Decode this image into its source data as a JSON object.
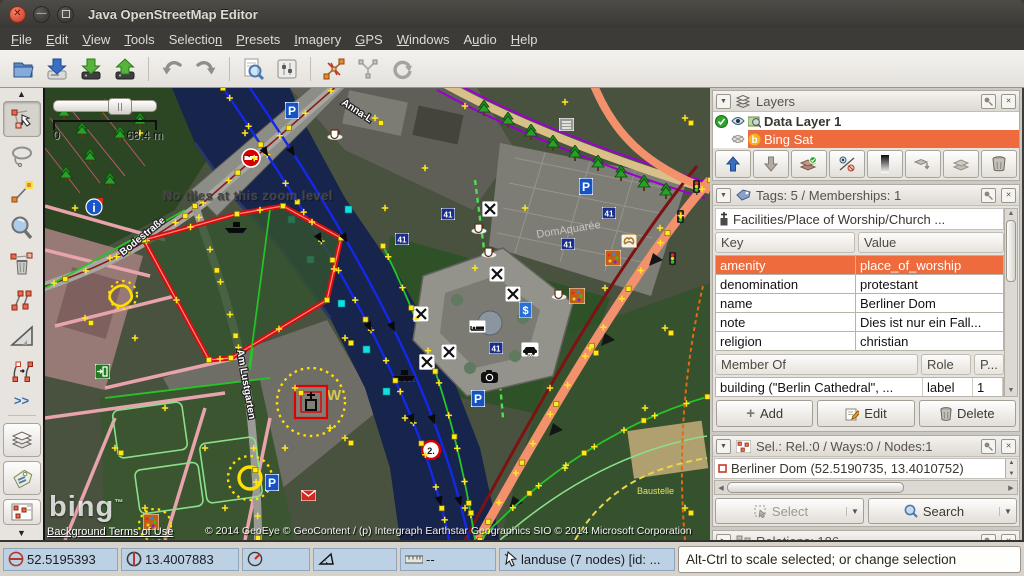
{
  "window": {
    "title": "Java OpenStreetMap Editor"
  },
  "menubar": {
    "items": [
      {
        "label": "File",
        "u": 0
      },
      {
        "label": "Edit",
        "u": 0
      },
      {
        "label": "View",
        "u": 0
      },
      {
        "label": "Tools",
        "u": 0
      },
      {
        "label": "Selection",
        "u": 8
      },
      {
        "label": "Presets",
        "u": 0
      },
      {
        "label": "Imagery",
        "u": 0
      },
      {
        "label": "GPS",
        "u": 0
      },
      {
        "label": "Windows",
        "u": 0
      },
      {
        "label": "Audio",
        "u": 1
      },
      {
        "label": "Help",
        "u": 0
      }
    ]
  },
  "toolbar": {
    "icons": [
      "open-file",
      "download-osm-data",
      "download-along",
      "upload-changes",
      "undo",
      "redo",
      "search",
      "preferences",
      "split-way",
      "combine-way",
      "refresh"
    ]
  },
  "side_toolbar": {
    "icons": [
      "scroll-up",
      "select-move-tool",
      "lasso-tool",
      "draw-nodes-tool",
      "zoom-tool",
      "delete-tool",
      "unglue-tool",
      "improve-accuracy-tool",
      "parallel-way-tool"
    ],
    "more_label": ">>",
    "toggles": [
      "layers-panel-toggle",
      "tags-panel-toggle",
      "selection-panel-toggle"
    ]
  },
  "map": {
    "scale_zero": "0",
    "scale_label": "68.4 m",
    "no_tiles_text": "No tiles at this zoom level",
    "bing_logo": "bing",
    "bing_tm": "™",
    "terms_link": "Background Terms of Use",
    "attribution": "© 2014 GeoEye © GeoContent / (p) Intergraph Earthstar Geographics SIO © 2014 Microsoft Corporation",
    "street_bodestrasse": "Bodestraße",
    "street_am_lustgarten": "Am Lustgarten",
    "street_anna": "Anna-L",
    "place_domaquaree": "DomAquarée",
    "note_baustelle": "Baustelle",
    "speed_badge": "41",
    "taxi_label": "TAXI",
    "parking_letter": "P",
    "bank_symbol": "$",
    "info_letter": "i",
    "sign_2": "2.",
    "watermark_w": "W"
  },
  "layers_panel": {
    "title": "Layers",
    "layers": [
      {
        "name": "Data Layer 1",
        "active": true,
        "visible": true
      },
      {
        "name": "Bing Sat",
        "active": false,
        "visible": false,
        "selected": true
      }
    ],
    "toolbar_icons": [
      "move-layer-up",
      "move-layer-down",
      "merge-layer",
      "toggle-visibility",
      "opacity",
      "duplicate-layer",
      "dim-layers",
      "delete-layer"
    ]
  },
  "tags_panel": {
    "title": "Tags: 5 / Memberships: 1",
    "preset": "Facilities/Place of Worship/Church ...",
    "key_header": "Key",
    "value_header": "Value",
    "tags": [
      [
        "amenity",
        "place_of_worship"
      ],
      [
        "denomination",
        "protestant"
      ],
      [
        "name",
        "Berliner Dom"
      ],
      [
        "note",
        "Dies ist nur ein Fall..."
      ],
      [
        "religion",
        "christian"
      ]
    ],
    "member_header": "Member Of",
    "role_header": "Role",
    "position_header": "P...",
    "membership": {
      "relation": "building (\"Berlin Cathedral\", ...",
      "role": "label",
      "position": "1"
    },
    "add_label": "Add",
    "edit_label": "Edit",
    "delete_label": "Delete"
  },
  "selection_panel": {
    "title": "Sel.: Rel.:0 / Ways:0 / Nodes:1",
    "item": "Berliner Dom (52.5190735, 13.4010752)",
    "select_label": "Select",
    "search_label": "Search"
  },
  "relations_panel": {
    "title": "Relations: 186"
  },
  "statusbar": {
    "lat": "52.5195393",
    "lon": "13.4007883",
    "heading": "",
    "angle": "",
    "distance": "--",
    "object_info": "landuse (7 nodes) [id: ...",
    "hint": "Alt-Ctrl to scale selected; or change selection"
  },
  "colors": {
    "accent_orange": "#ed6b3c",
    "status_blue": "#bdd1e4",
    "selection_red": "#d40000",
    "node_yellow": "#ffe81e",
    "water_navy": "#17244c"
  }
}
